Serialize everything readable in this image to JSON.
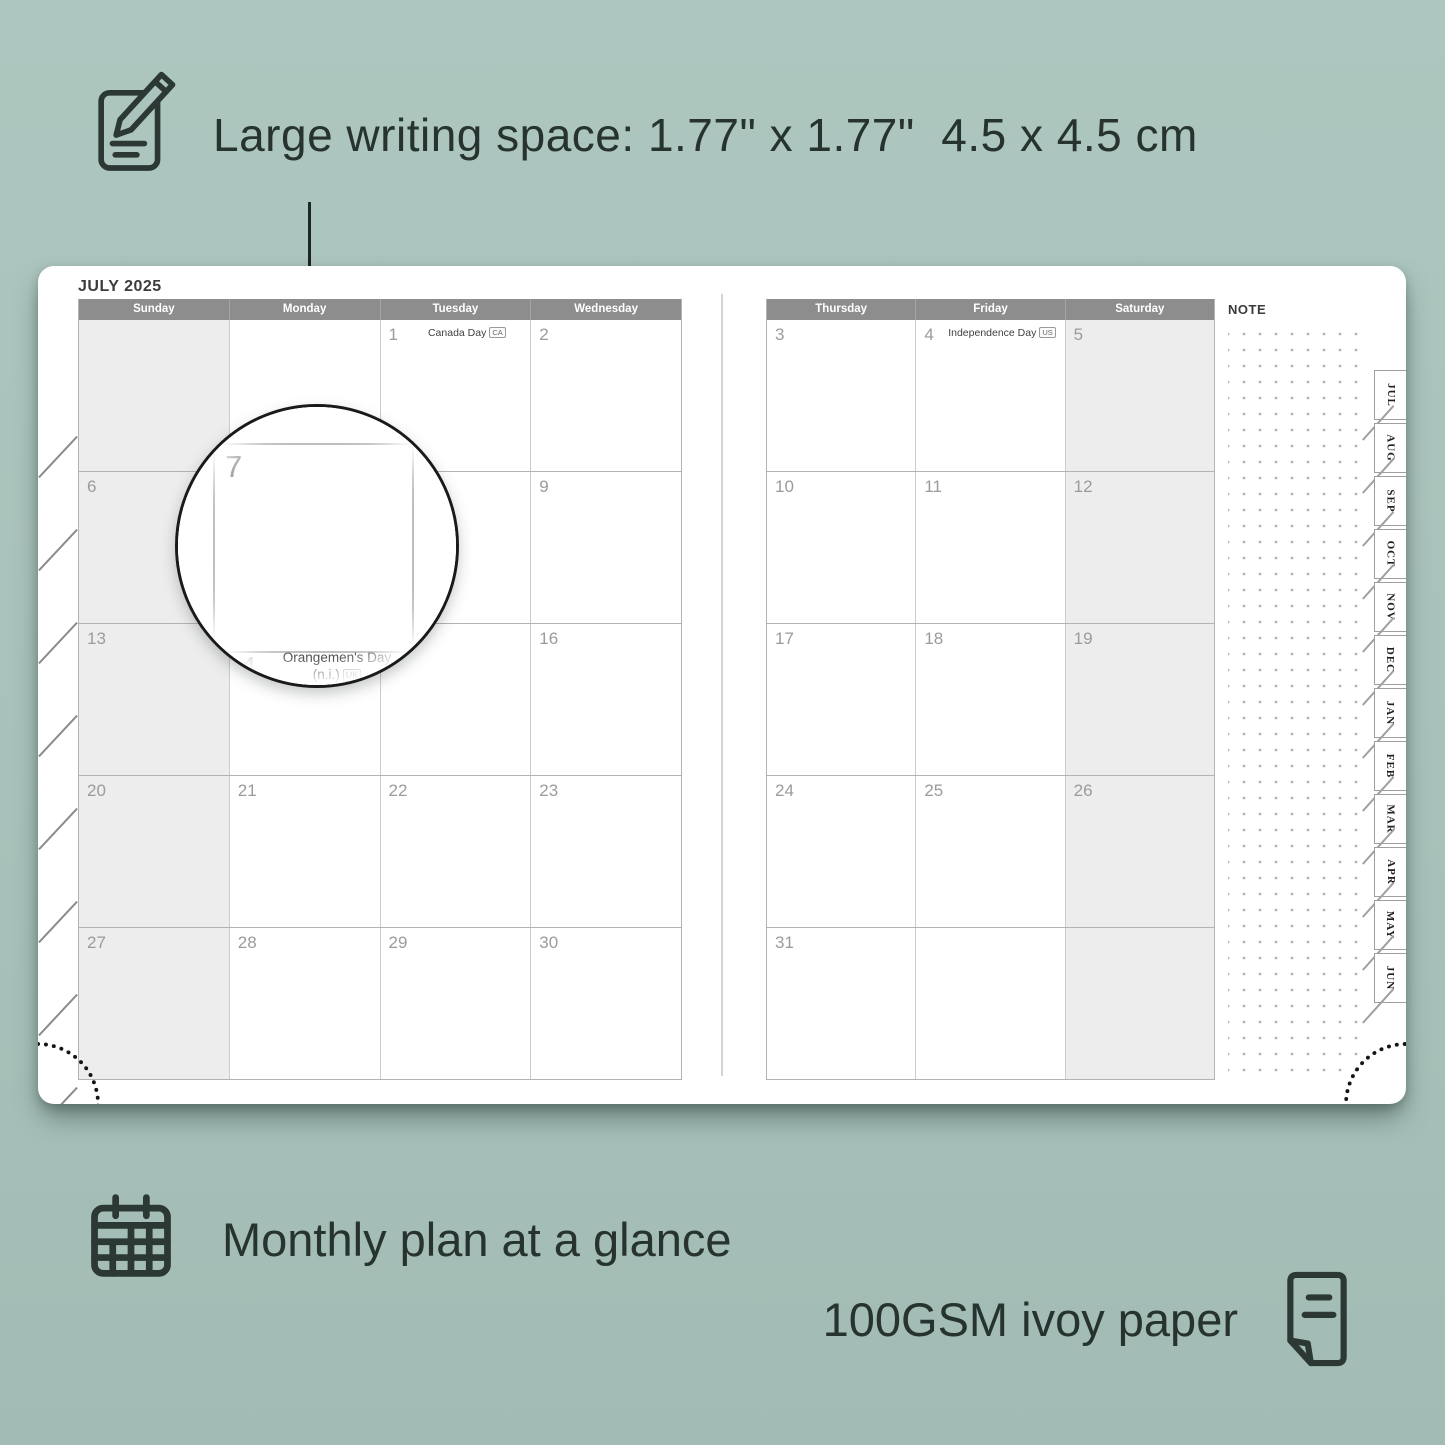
{
  "background": "#a8c2bb",
  "accent_dark": "#26332e",
  "callout": {
    "text": "Large writing space: 1.77\" x 1.77\"  4.5 x 4.5 cm"
  },
  "planner": {
    "month_title": "JULY 2025",
    "note_label": "NOTE",
    "left_headers": [
      "Sunday",
      "Monday",
      "Tuesday",
      "Wednesday"
    ],
    "right_headers": [
      "Thursday",
      "Friday",
      "Saturday"
    ],
    "left_rows": [
      [
        {
          "d": ""
        },
        {
          "d": ""
        },
        {
          "d": "1",
          "h": "Canada Day",
          "b": "CA"
        },
        {
          "d": "2"
        }
      ],
      [
        {
          "d": "6"
        },
        {
          "d": "7"
        },
        {
          "d": "8"
        },
        {
          "d": "9"
        }
      ],
      [
        {
          "d": "13"
        },
        {
          "d": "14",
          "h": "Orangemen's Day",
          "h2": "(n.i.)",
          "b": "UK"
        },
        {
          "d": "15"
        },
        {
          "d": "16"
        }
      ],
      [
        {
          "d": "20"
        },
        {
          "d": "21"
        },
        {
          "d": "22"
        },
        {
          "d": "23"
        }
      ],
      [
        {
          "d": "27"
        },
        {
          "d": "28"
        },
        {
          "d": "29"
        },
        {
          "d": "30"
        }
      ]
    ],
    "right_rows": [
      [
        {
          "d": "3"
        },
        {
          "d": "4",
          "h": "Independence Day",
          "b": "US"
        },
        {
          "d": "5"
        }
      ],
      [
        {
          "d": "10"
        },
        {
          "d": "11"
        },
        {
          "d": "12"
        }
      ],
      [
        {
          "d": "17"
        },
        {
          "d": "18"
        },
        {
          "d": "19"
        }
      ],
      [
        {
          "d": "24"
        },
        {
          "d": "25"
        },
        {
          "d": "26"
        }
      ],
      [
        {
          "d": "31"
        },
        {
          "d": ""
        },
        {
          "d": ""
        }
      ]
    ],
    "tabs": [
      "JUL",
      "AUG",
      "SEP",
      "OCT",
      "NOV",
      "DEC",
      "JAN",
      "FEB",
      "MAR",
      "APR",
      "MAY",
      "JUN"
    ]
  },
  "magnifier": {
    "day": "7",
    "next_day": "14",
    "holiday_line1": "Orangemen's Day",
    "holiday_line2": "(n.i.)",
    "badge": "UK"
  },
  "captions": {
    "monthly": "Monthly plan at a glance",
    "paper": "100GSM ivoy paper"
  }
}
